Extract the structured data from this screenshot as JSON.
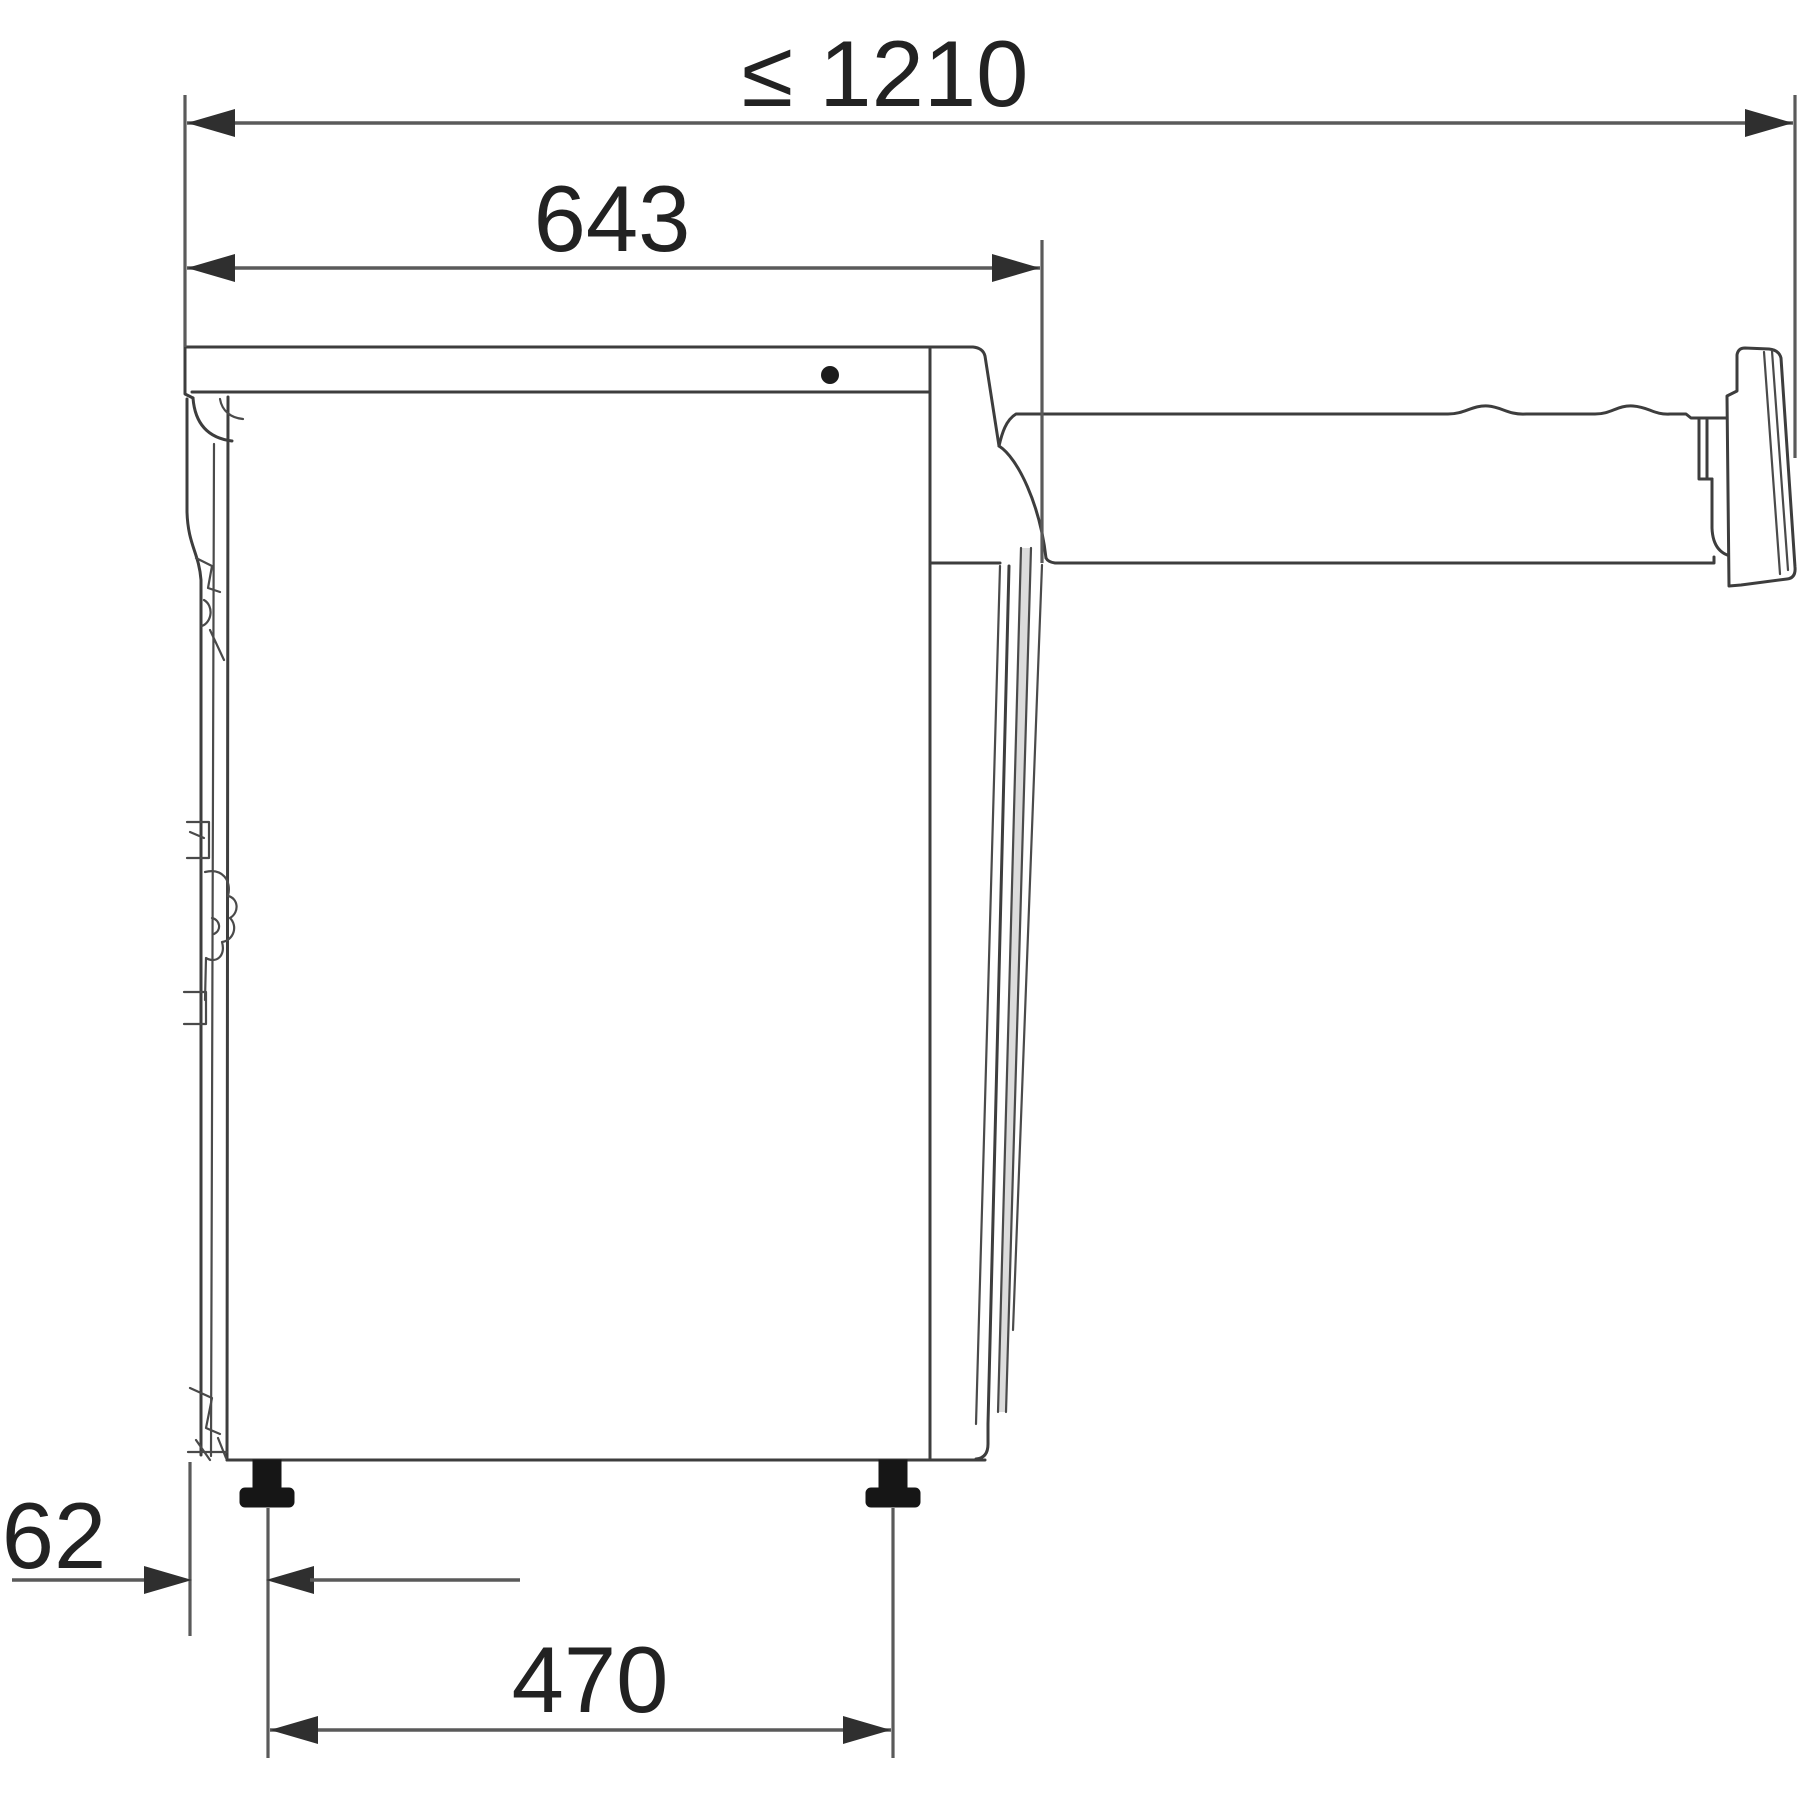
{
  "title": "Appliance side view installation dimensions",
  "diagram": {
    "type": "technical-dimension-drawing",
    "unit": "mm",
    "dimensions": [
      {
        "id": "max-overall-depth",
        "label": "≤ 1210",
        "measures": "front face to wall connection end"
      },
      {
        "id": "appliance-depth",
        "label": "643",
        "measures": "front face to rear panel"
      },
      {
        "id": "front-to-foot-offset",
        "label": "62",
        "measures": "front face to front foot centre"
      },
      {
        "id": "foot-spacing",
        "label": "470",
        "measures": "front foot centre to rear foot centre"
      }
    ],
    "colors": {
      "line": "#3d3d3d",
      "dimension_line": "#5a5a5a",
      "text": "#222222",
      "foot_fill": "#161616",
      "background": "#ffffff"
    }
  }
}
